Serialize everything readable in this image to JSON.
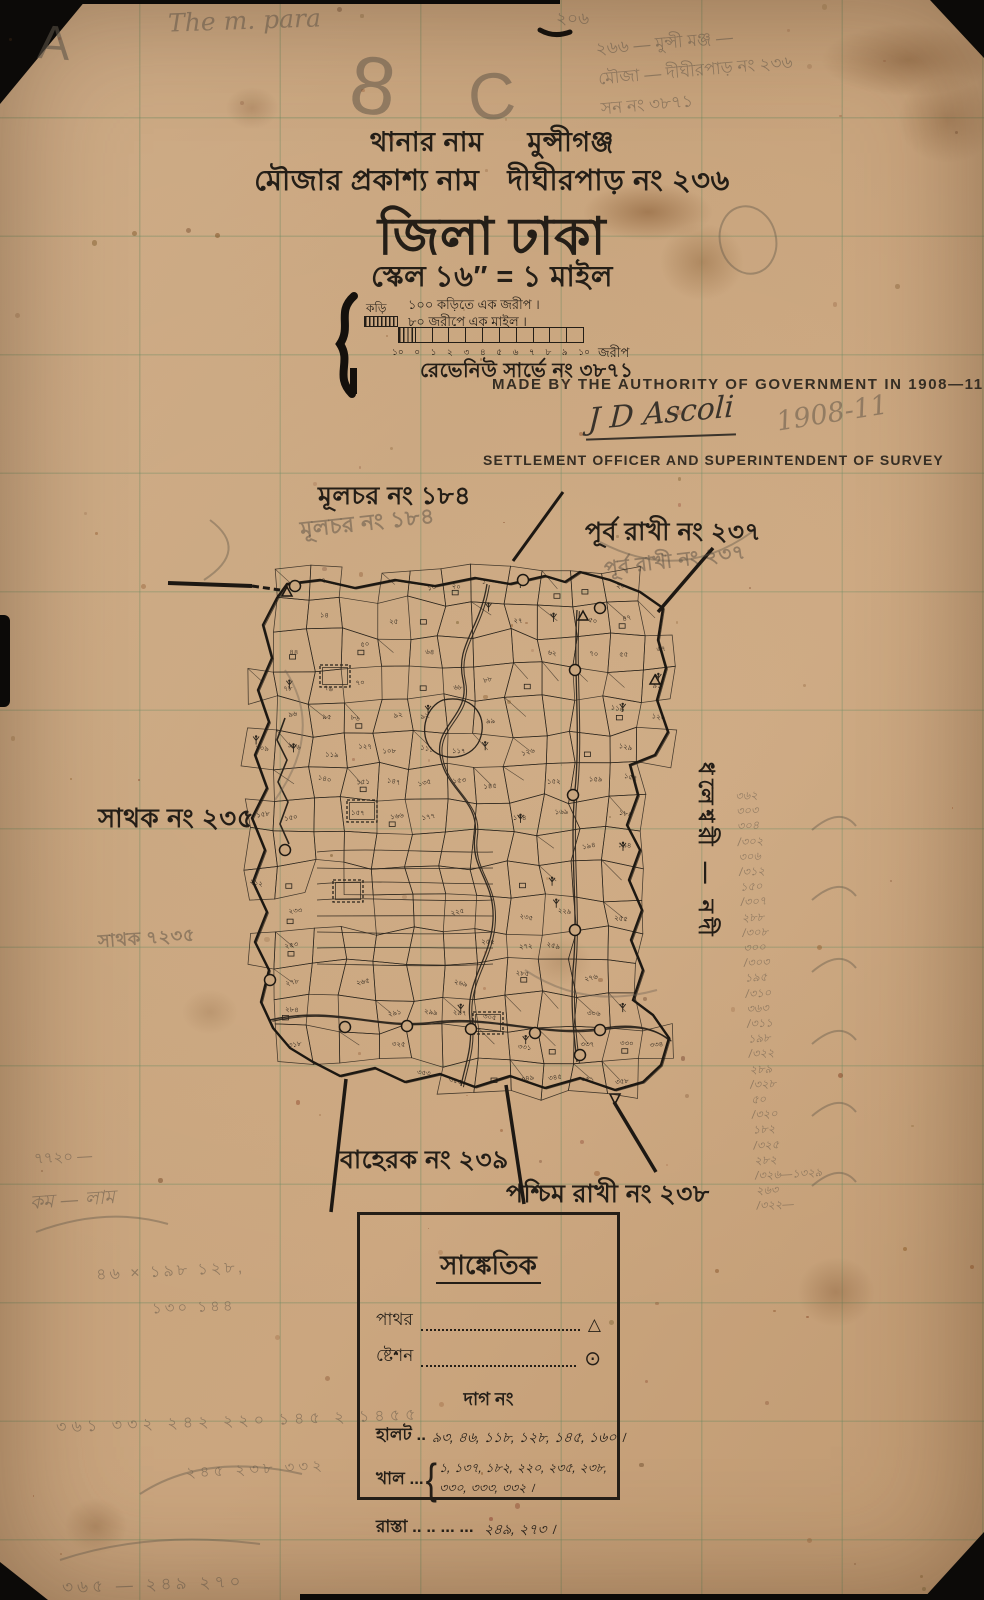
{
  "header": {
    "thana_label": "থানার নাম",
    "thana_value": "মুন্সীগঞ্জ",
    "mouza_label": "মৌজার প্রকাশ্য নাম",
    "mouza_value": "দীঘীরপাড় নং ২৩৬",
    "district_line": "জিলা ঢাকা",
    "scale_line": "স্কেল ১৬″ = ১ মাইল"
  },
  "scale_bar": {
    "line1": "১০০ কড়িতে এক জরীপ ।",
    "line2": "৮০ জরীপে এক মাইল ।",
    "left_label": "কড়ি",
    "ticks": [
      "১০",
      "০",
      "১",
      "২",
      "৩",
      "৪",
      "৫",
      "৬",
      "৭",
      "৮",
      "৯",
      "১০"
    ],
    "unit": "জরীপ",
    "survey_no_line": "রেভেনিউ সার্ভে নং ৩৮৭১"
  },
  "english": {
    "authority_line": "MADE BY THE AUTHORITY OF GOVERNMENT IN 1908—11",
    "signature": "J D Ascoli",
    "signature_year_pencil": "1908-11",
    "officer_line": "SETTLEMENT OFFICER AND SUPERINTENDENT OF SURVEY"
  },
  "boundary_labels": {
    "north_west": "মূলচর নং ১৮৪",
    "north_east": "পূর্ব রাখী নং ২৩৭",
    "west": "সাথক নং ২৩৫",
    "south": "বাহেরক নং ২৩৯",
    "south_east": "পশ্চিম রাখী নং ২৩৮",
    "east_vertical": "ধলেশ্বরী — নদী"
  },
  "legend": {
    "title": "সাঙ্কেতিক",
    "symbol_rows": [
      {
        "label": "পাথর",
        "symbol": "△"
      },
      {
        "label": "ষ্টেশন",
        "symbol": "⊙"
      }
    ],
    "dag_heading": "দাগ নং",
    "halot_label": "হালট ..",
    "halot_values": "৯৩, ৪৬, ১১৮, ১২৮, ১৪৫, ১৬০ ।",
    "khal_label": "খাল ...",
    "khal_brace": "{",
    "khal_values_line1": "১, ১৩৭, ১৮২, ২২০, ২৩৫, ২৩৮,",
    "khal_values_line2": "৩৩০, ৩৩৩, ৩৩২ ।",
    "rasta_label": "রাস্তা .. .. ... ...",
    "rasta_values": "২৪৯, ২৭৩ ।"
  },
  "pencil": {
    "corner_letter": "A",
    "top_cursive": "The m. para",
    "big_mark_1": "8",
    "big_mark_2": "C",
    "top_small": "২০৬",
    "top_right_lines": [
      "২৬৬ — মুন্সী মঞ্জ —",
      "মৌজা — দীঘীরপাড় নং ২৩৬",
      "সন নং ৩৮৭১"
    ],
    "nw_ghost": "মূলচর নং ১৮৪",
    "ne_ghost": "পূর্ব রাখী নং ২৩৭",
    "sw_ghost": "সাথক ৭২৩৫",
    "margin_numbers": [
      "৩৬২",
      "৩০৩",
      "৩০৪",
      "/৩০২",
      "৩০৬",
      "/৩১২",
      "১৫০",
      "/৩০৭",
      "২৮৮",
      "/৩০৮",
      "৩০০",
      "/৩০৩",
      "১৯৫",
      "/৩১০",
      "৩৬৩",
      "/৩১১",
      "১৯৮",
      "/৩২২",
      "২৮৯",
      "/৩২৮",
      "৫০",
      "/৩২০",
      "১৮২",
      "/৩২৫",
      "২৮২",
      "/৩২৬—১৩২৯",
      "২৬৩",
      "/৩২২—"
    ],
    "bottom_lines": [
      "৭৭২০ —",
      "কম — লাম",
      "৪৬ × ১৯৮ ১২৮,",
      "১৩০ ১৪৪",
      "৩৬১ ৩৩২ ২৪২ ২২০ ১৪৫ ২ ১৪৫৫",
      "২৪৫ ২৩৮ ৩৩২",
      "৩৬৫ — ২৪৯  ২৭০"
    ]
  }
}
